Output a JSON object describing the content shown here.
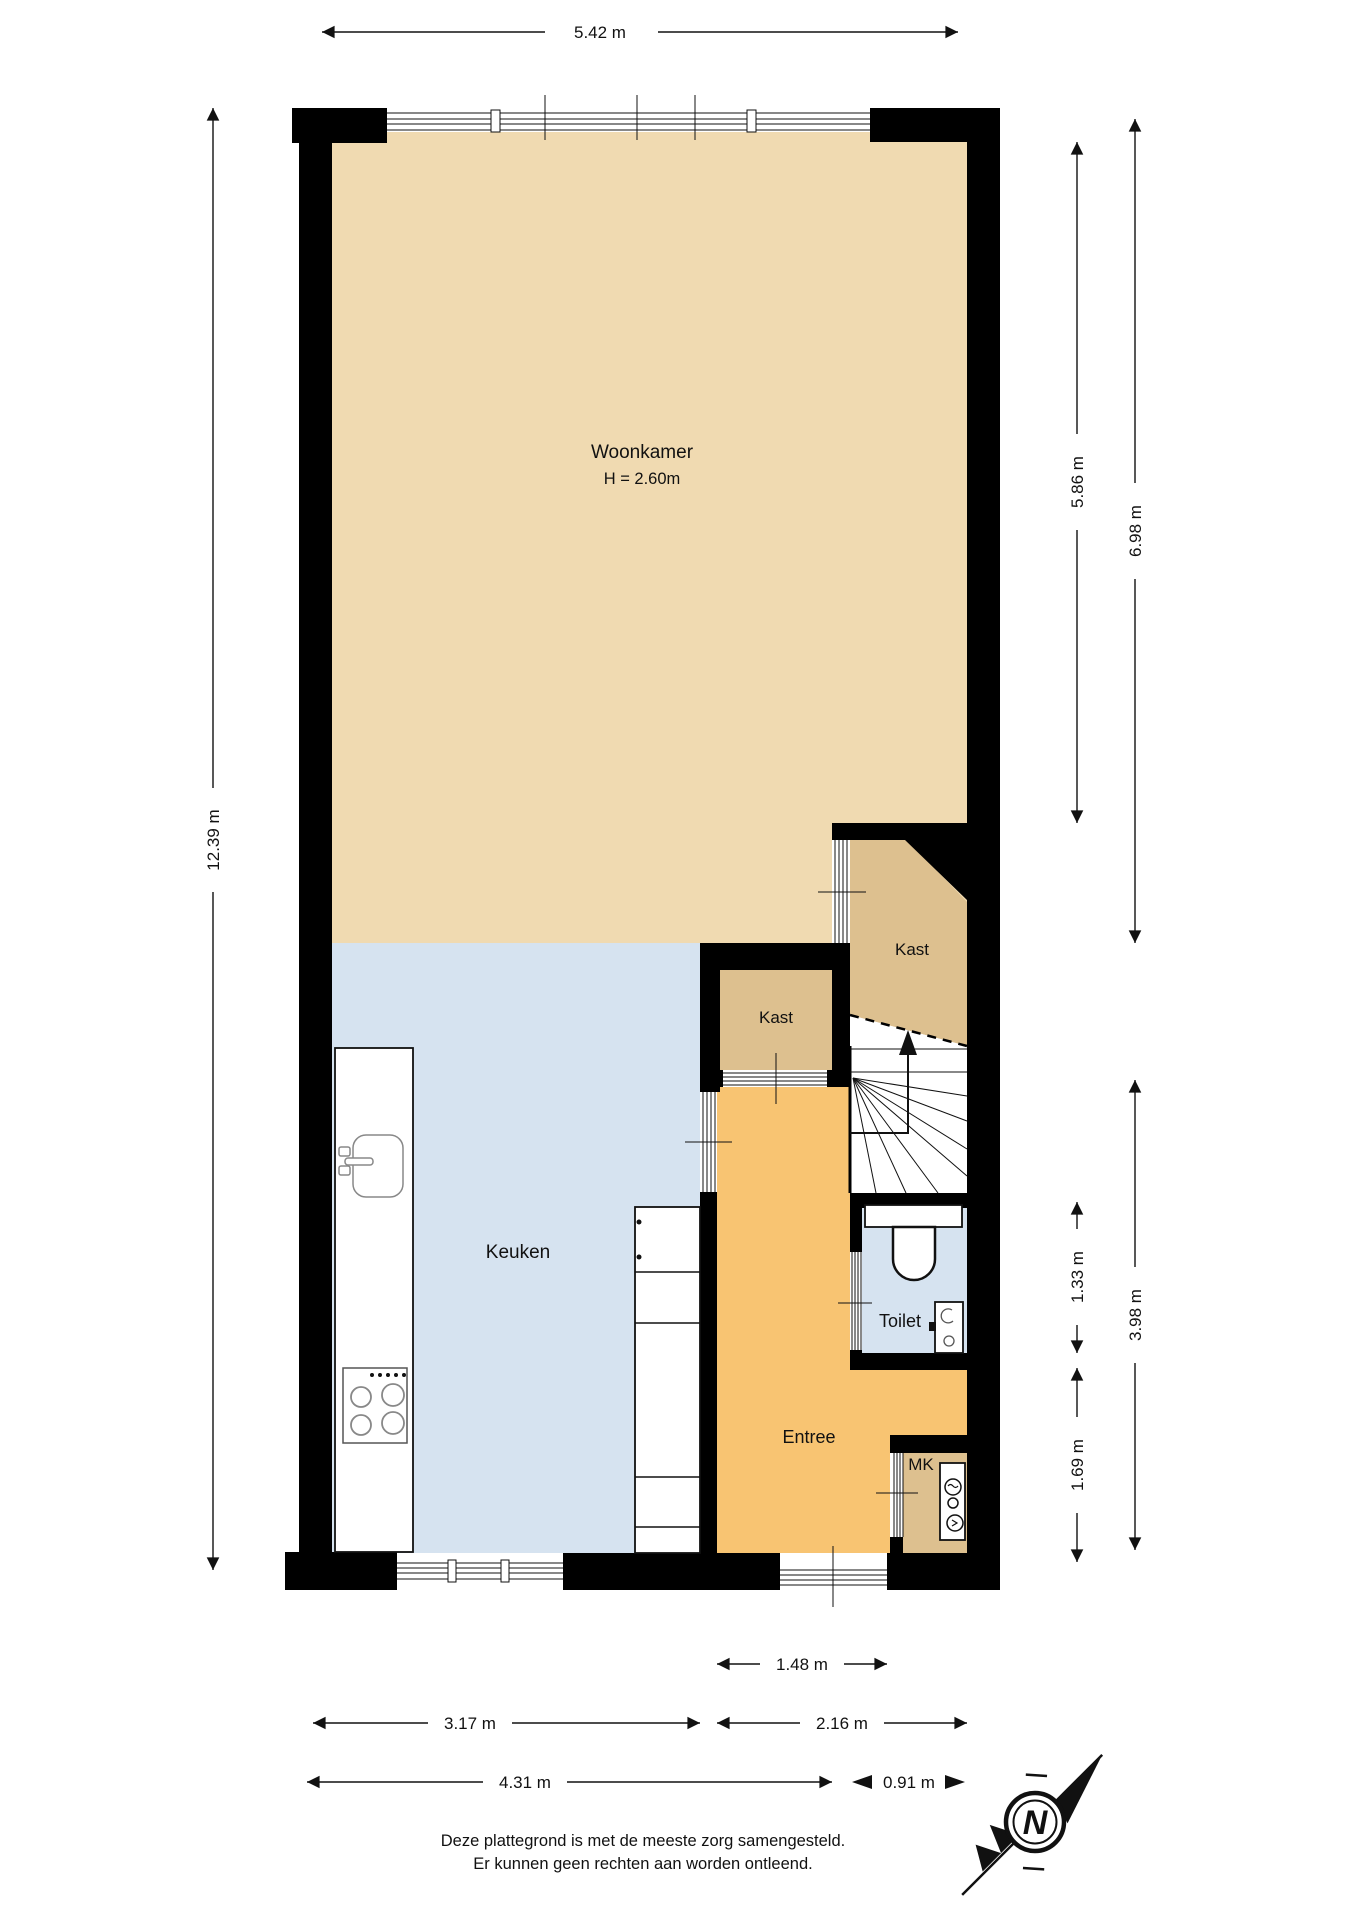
{
  "title": "floor-plan",
  "rooms": {
    "woonkamer": {
      "label": "Woonkamer",
      "height_note": "H = 2.60m"
    },
    "keuken": {
      "label": "Keuken"
    },
    "kast_boven": {
      "label": "Kast"
    },
    "kast_onder": {
      "label": "Kast"
    },
    "toilet": {
      "label": "Toilet"
    },
    "entree": {
      "label": "Entree"
    },
    "mk": {
      "label": "MK"
    }
  },
  "dimensions": {
    "top_width": "5.42 m",
    "left_total_height": "12.39 m",
    "right_woonkamer_inner": "5.86 m",
    "right_woonkamer_outer": "6.98 m",
    "right_toilet": "1.33 m",
    "right_entree_lower": "1.69 m",
    "right_hall_total": "3.98 m",
    "bottom_entree_width": "1.48 m",
    "bottom_keuken_width": "3.17 m",
    "bottom_hall_width": "2.16 m",
    "bottom_total_left": "4.31 m",
    "bottom_total_right": "0.91 m"
  },
  "compass": {
    "north_letter": "N"
  },
  "footer": {
    "line1": "Deze plattegrond is met de meeste zorg samengesteld.",
    "line2": "Er kunnen geen rechten aan worden ontleend."
  },
  "colors": {
    "floor_living": "#f0dab1",
    "floor_kitchen": "#d6e3f0",
    "floor_closet": "#ddc08f",
    "floor_hall": "#f8c472",
    "wall": "#000000"
  }
}
